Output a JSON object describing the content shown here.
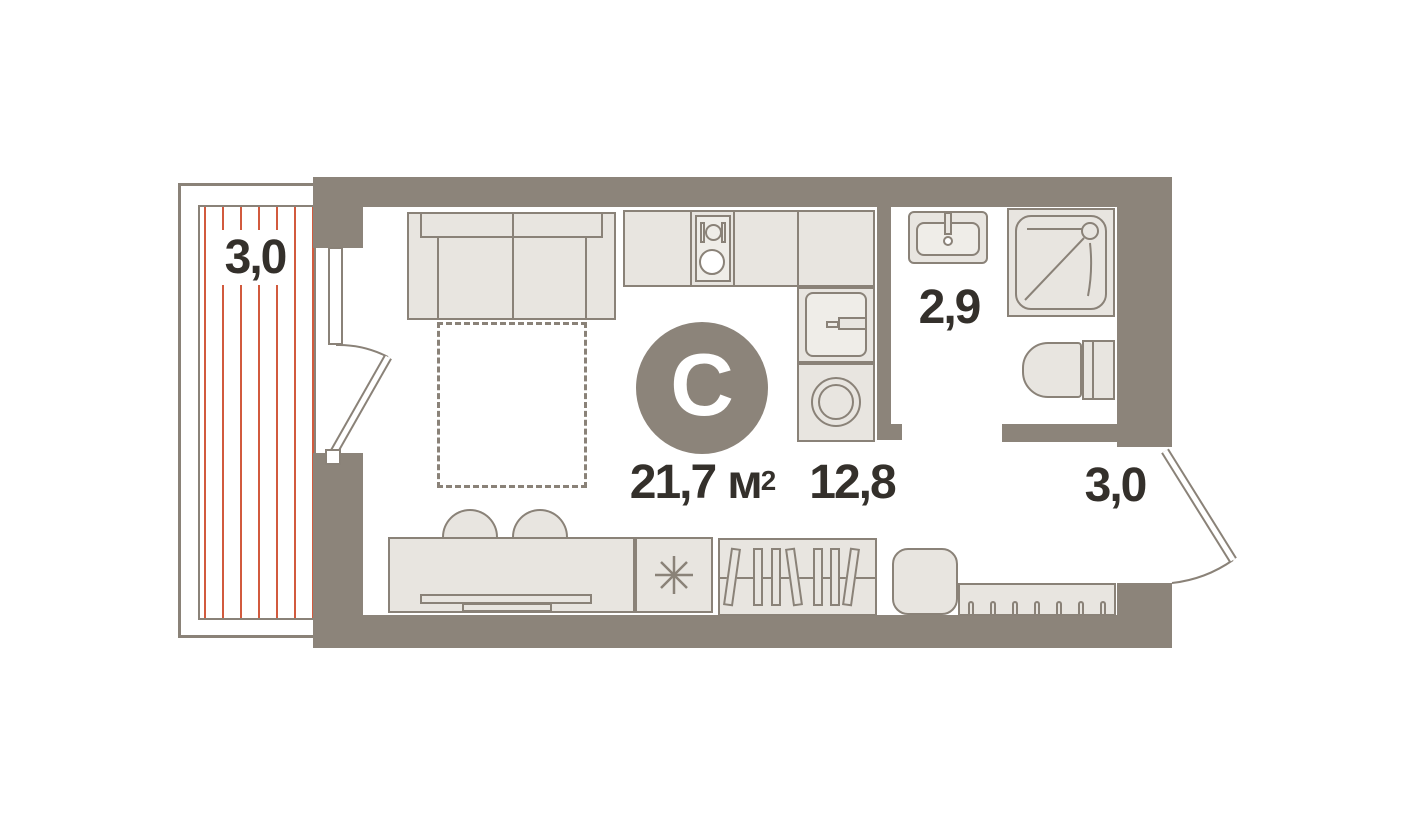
{
  "floor_plan": {
    "studio_badge": "С",
    "total_area": {
      "value": "21,7",
      "unit": "м",
      "sup": "2"
    },
    "areas": {
      "balcony": "3,0",
      "kitchen_living": "12,8",
      "bathroom": "2,9",
      "hallway": "3,0"
    },
    "colors": {
      "wall": "#8c847a",
      "outline": "#8a8278",
      "furniture": "#e8e5e0",
      "hatch": "#d25a3e",
      "text": "#34302b",
      "badge_text": "#ffffff"
    }
  }
}
